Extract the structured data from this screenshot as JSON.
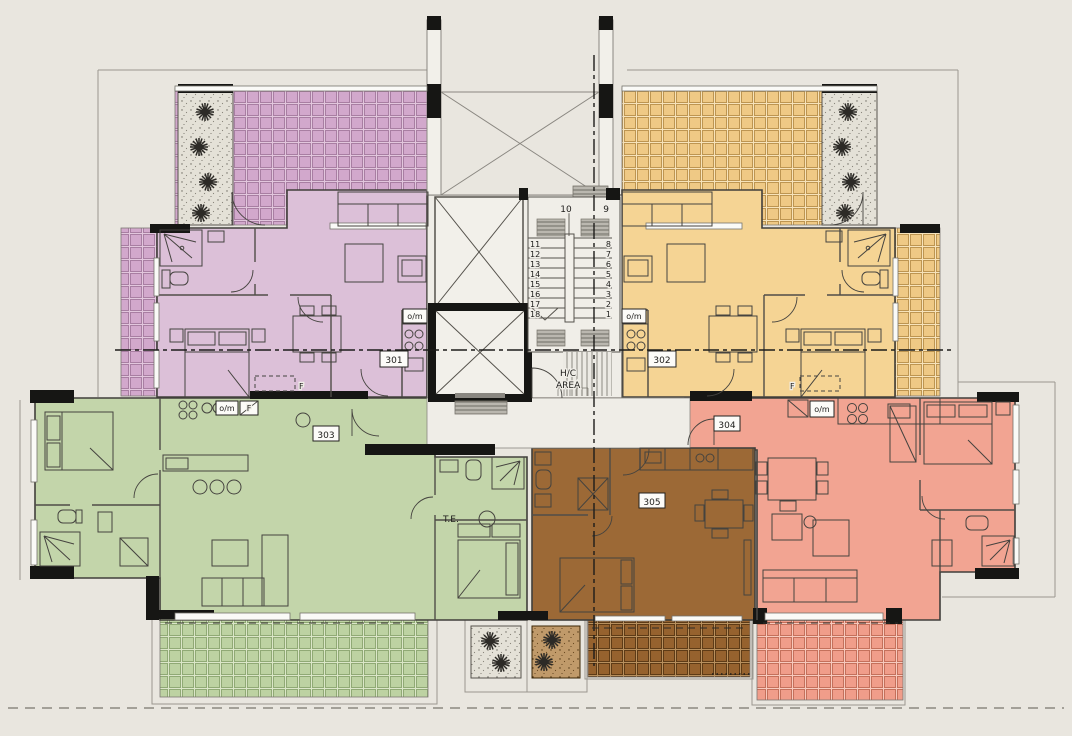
{
  "drawing": {
    "background_color": "#e9e6df",
    "wall_color": "#161614",
    "units": [
      {
        "label": "301",
        "name": "apartment-301",
        "position": "top-left",
        "color": "#dcc0d8",
        "balcony_color": "#d2a8cc"
      },
      {
        "label": "302",
        "name": "apartment-302",
        "position": "top-right",
        "color": "#f5d494",
        "balcony_color": "#efc985"
      },
      {
        "label": "303",
        "name": "apartment-303",
        "position": "bottom-left",
        "color": "#c3d5aa",
        "balcony_color": "#bdd2a2"
      },
      {
        "label": "304",
        "name": "apartment-304",
        "position": "bottom-right",
        "color": "#f2a492",
        "balcony_color": "#f09d8a"
      },
      {
        "label": "305",
        "name": "apartment-305",
        "position": "bottom-center",
        "color": "#9c6936",
        "balcony_color": "#96622e"
      }
    ],
    "core": {
      "stair_top_numbers": [
        "10",
        "9"
      ],
      "stair_left_numbers": [
        "11",
        "12",
        "13",
        "14",
        "15",
        "16",
        "17",
        "18"
      ],
      "stair_right_numbers": [
        "8",
        "7",
        "6",
        "5",
        "4",
        "3",
        "2",
        "1"
      ],
      "hc_area": [
        "H/C",
        "AREA"
      ]
    },
    "labels": {
      "te": "T.E.",
      "om": "o/m",
      "fridge": "F"
    }
  }
}
